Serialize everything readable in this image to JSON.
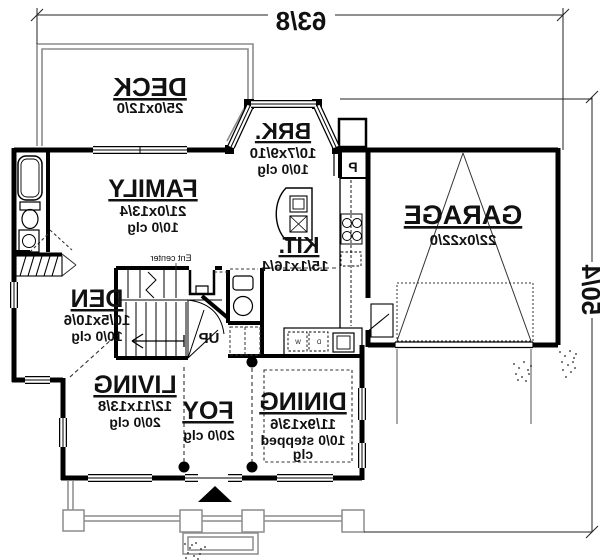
{
  "drawing": {
    "dim_width": "63/8",
    "dim_depth": "50/4",
    "rooms": [
      {
        "id": "deck",
        "name": "DECK",
        "size": "25/0x12/0",
        "ceiling": ""
      },
      {
        "id": "brk",
        "name": "BRK.",
        "size": "10/7x9/10",
        "ceiling": "10/0 clg"
      },
      {
        "id": "family",
        "name": "FAMILY",
        "size": "21/0x13/4",
        "ceiling": "10/0 clg"
      },
      {
        "id": "garage",
        "name": "GARAGE",
        "size": "22/0x22/0",
        "ceiling": ""
      },
      {
        "id": "kitchen",
        "name": "KIT.",
        "size": "15/1x16/4",
        "ceiling": ""
      },
      {
        "id": "den",
        "name": "DEN",
        "size": "10/5x10/6",
        "ceiling": "10/0 clg"
      },
      {
        "id": "living",
        "name": "LIVING",
        "size": "12/11x13/8",
        "ceiling": "20/0 clg"
      },
      {
        "id": "foyer",
        "name": "FOY",
        "size": "",
        "ceiling": "20/0 clg"
      },
      {
        "id": "dining",
        "name": "DINING",
        "size": "11/9x13/6",
        "ceiling": "10/0 stepped",
        "ceiling2": "clg"
      }
    ],
    "labels": {
      "up": "UP",
      "pantry": "P",
      "ent_center": "Ent center",
      "washer": "W",
      "dryer": "D"
    },
    "colors": {
      "wall": "#000000",
      "site": "#8c8c8c",
      "background": "#ffffff"
    },
    "note": "mirrored floor plan"
  }
}
